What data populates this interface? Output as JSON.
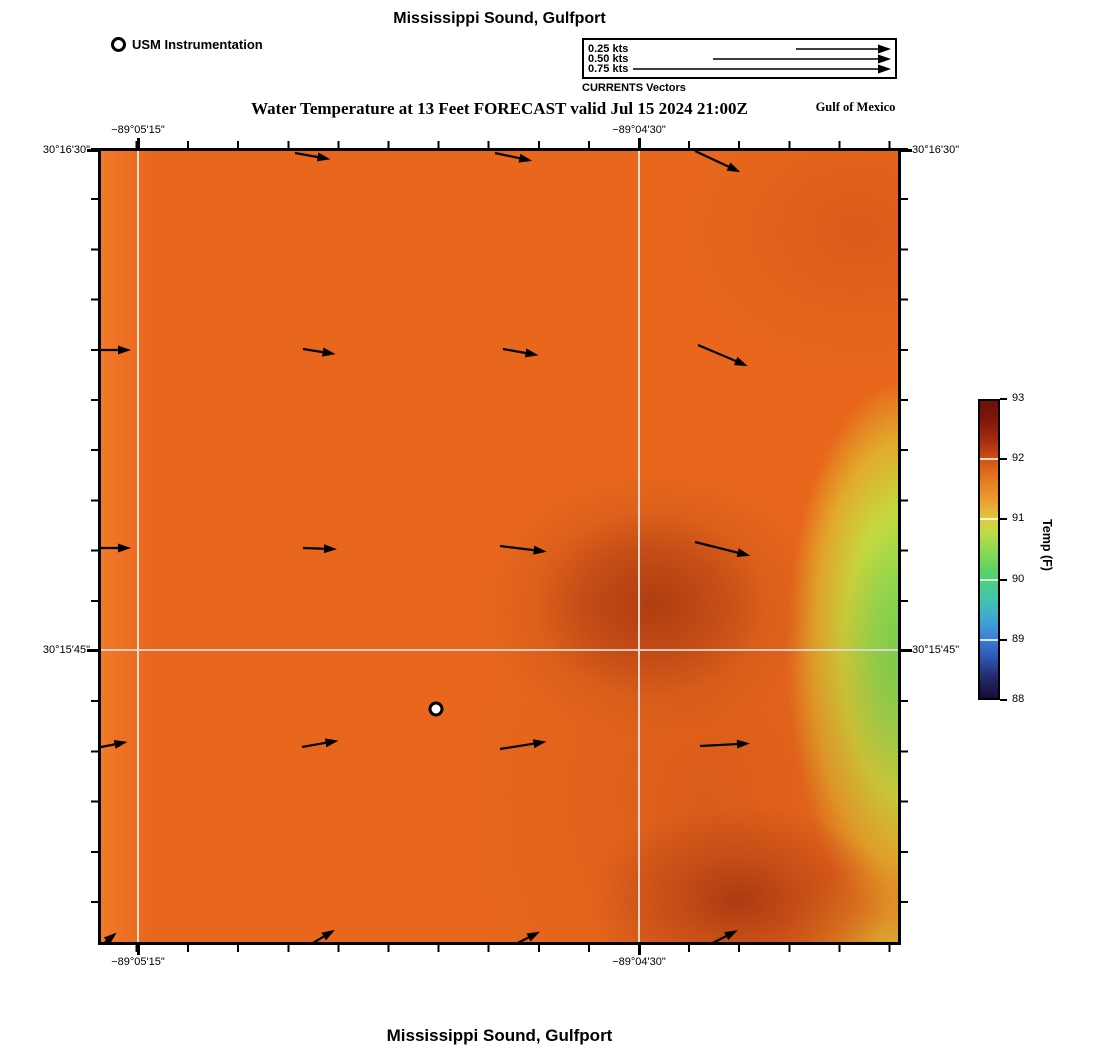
{
  "titles": {
    "top": "Mississippi Sound, Gulfport",
    "subtitle": "Water Temperature at 13 Feet FORECAST valid Jul 15 2024 21:00Z",
    "region": "Gulf of Mexico",
    "bottom": "Mississippi Sound, Gulfport"
  },
  "legend": {
    "station_label": "USM Instrumentation",
    "vectors_caption": "CURRENTS Vectors",
    "vector_items": [
      {
        "label": "0.25 kts",
        "speed_kts": 0.25,
        "line_px": 82
      },
      {
        "label": "0.50 kts",
        "speed_kts": 0.5,
        "line_px": 165
      },
      {
        "label": "0.75 kts",
        "speed_kts": 0.75,
        "line_px": 245
      }
    ]
  },
  "axes": {
    "lon_labels": [
      "−89°05'15\"",
      "−89°04'30\""
    ],
    "lat_labels": [
      "30°16'30\"",
      "30°15'45\""
    ]
  },
  "colors": {
    "base_orange": "#e8671c",
    "hot_spot_red": "#b0401a",
    "green_edge": "#6fd24f",
    "yellow_band": "#c6d83f",
    "gridline": "#dedede"
  },
  "chart_data": {
    "type": "heatmap",
    "title": "Mississippi Sound, Gulfport",
    "subtitle": "Water Temperature at 13 Feet FORECAST valid Jul 15 2024 21:00Z",
    "x_axis": {
      "label": "Longitude",
      "ticks": [
        "−89°05'15\"",
        "−89°04'30\""
      ]
    },
    "y_axis": {
      "label": "Latitude",
      "ticks": [
        "30°16'30\"",
        "30°15'45\""
      ]
    },
    "legend_position": "top",
    "grid": true,
    "colorbar": {
      "label": "Temp (F)",
      "min": 88,
      "max": 93,
      "ticks_display": [
        93,
        92,
        91,
        90,
        89,
        88
      ],
      "palette_top_to_bottom": [
        "#6e1105",
        "#d35316",
        "#c3da45",
        "#4ed07c",
        "#3b7fd8",
        "#150d33"
      ]
    },
    "temperature_grid_F": {
      "note": "approximate values read from color field; rows north to south, cols west to east",
      "rows": [
        [
          91.8,
          91.8,
          91.8,
          91.9,
          92.1
        ],
        [
          91.8,
          91.8,
          91.8,
          92.0,
          91.6
        ],
        [
          91.8,
          91.8,
          92.4,
          92.1,
          90.3
        ],
        [
          91.8,
          91.9,
          92.0,
          92.2,
          90.6
        ],
        [
          91.8,
          91.9,
          92.1,
          92.6,
          91.2
        ]
      ]
    },
    "station": {
      "name": "USM Instrumentation",
      "x_px": 335,
      "y_px": 558
    },
    "current_vectors_note": "arrows ~0.10-0.17 kts, flowing eastward",
    "arrows": [
      {
        "x": 194,
        "y": 2,
        "len": 36,
        "ang": 10
      },
      {
        "x": 394,
        "y": 2,
        "len": 38,
        "ang": 12
      },
      {
        "x": 594,
        "y": 0,
        "len": 50,
        "ang": 25
      },
      {
        "x": -6,
        "y": 199,
        "len": 36,
        "ang": 0
      },
      {
        "x": 202,
        "y": 198,
        "len": 33,
        "ang": 9
      },
      {
        "x": 402,
        "y": 198,
        "len": 36,
        "ang": 10
      },
      {
        "x": 597,
        "y": 194,
        "len": 54,
        "ang": 23
      },
      {
        "x": -6,
        "y": 397,
        "len": 36,
        "ang": 0
      },
      {
        "x": 202,
        "y": 397,
        "len": 34,
        "ang": 2
      },
      {
        "x": 399,
        "y": 395,
        "len": 47,
        "ang": 7
      },
      {
        "x": 594,
        "y": 391,
        "len": 57,
        "ang": 14
      },
      {
        "x": -5,
        "y": 597,
        "len": 32,
        "ang": -11
      },
      {
        "x": 201,
        "y": 596,
        "len": 37,
        "ang": -10
      },
      {
        "x": 399,
        "y": 598,
        "len": 47,
        "ang": -9
      },
      {
        "x": 599,
        "y": 595,
        "len": 50,
        "ang": -3
      },
      {
        "x": -5,
        "y": 799,
        "len": 27,
        "ang": -40
      },
      {
        "x": 197,
        "y": 801,
        "len": 43,
        "ang": -31
      },
      {
        "x": 399,
        "y": 801,
        "len": 45,
        "ang": -27
      },
      {
        "x": 594,
        "y": 801,
        "len": 48,
        "ang": -27
      }
    ]
  }
}
